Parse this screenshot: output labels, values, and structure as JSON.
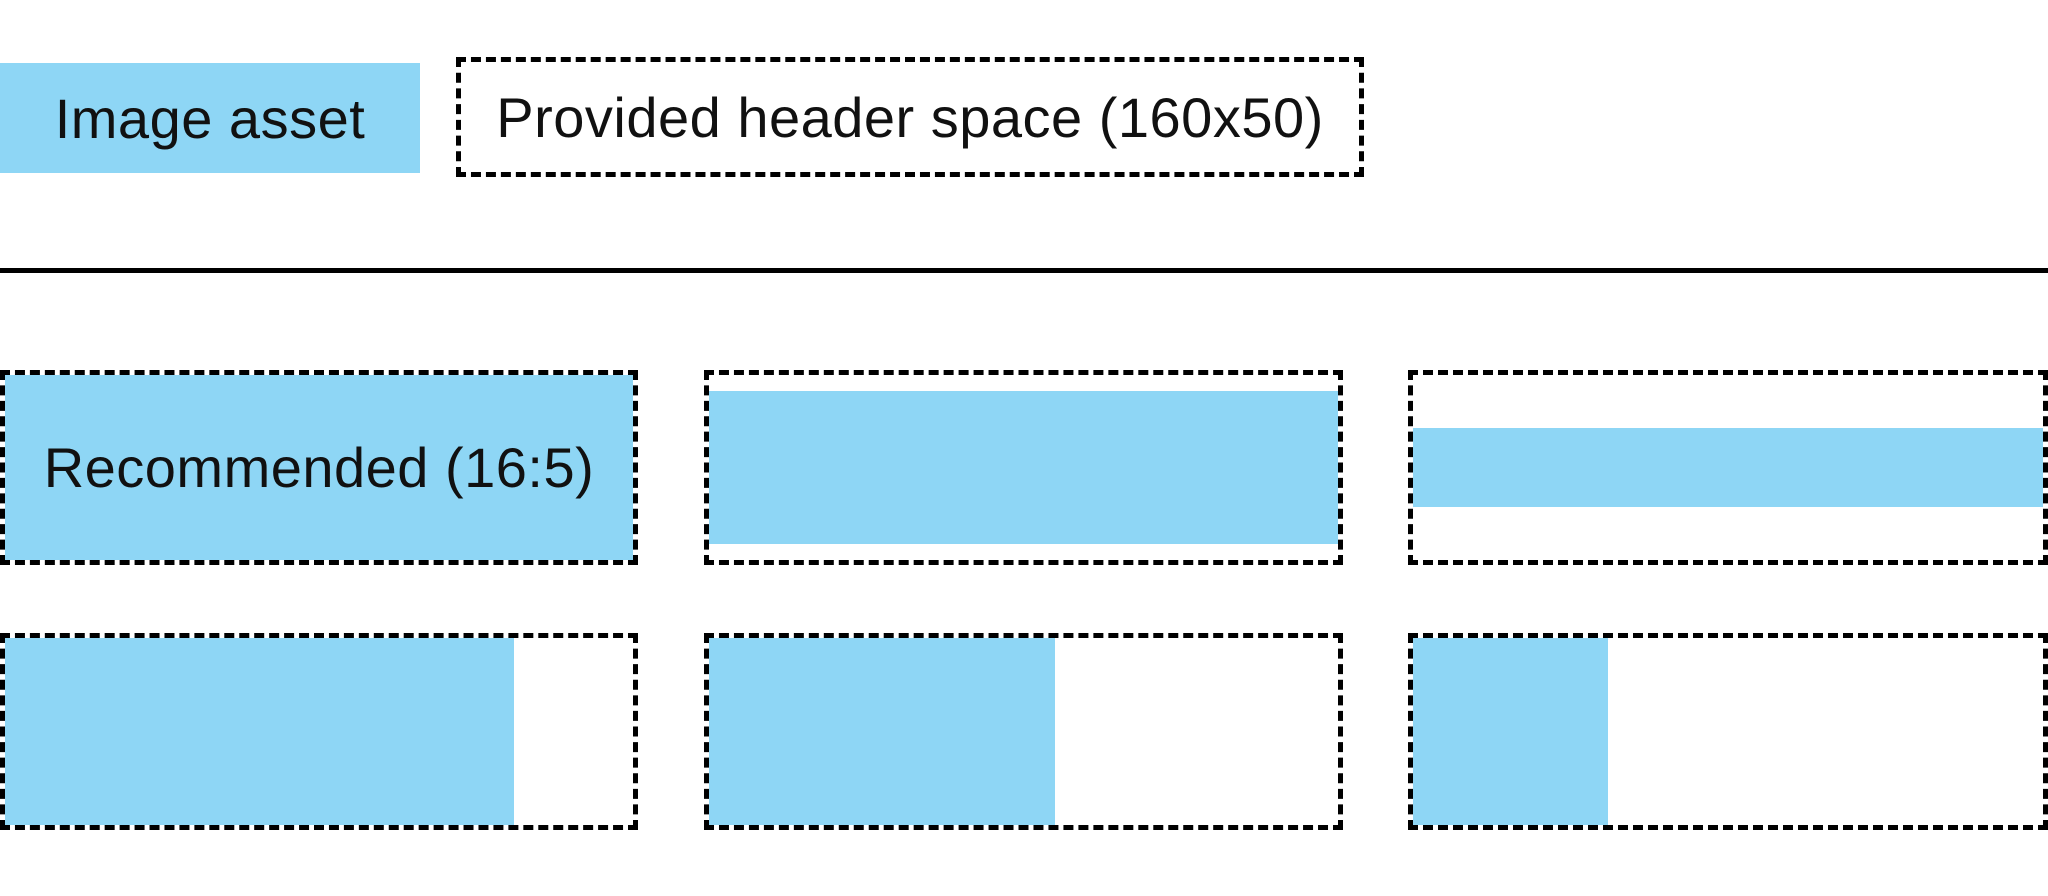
{
  "colors": {
    "asset_blue": "#8ed6f5",
    "outline": "#000000",
    "divider": "#000000",
    "text": "#111111",
    "background": "#ffffff"
  },
  "legend": {
    "image_asset_label": "Image asset",
    "header_space_label": "Provided header space (160x50)"
  },
  "examples": {
    "recommended_label": "Recommended (16:5)",
    "items": [
      {
        "name": "recommended-16-5",
        "label": "Recommended (16:5)",
        "fill": {
          "width_pct": 100,
          "height_pct": 100,
          "h_align": "left",
          "v_align": "center"
        }
      },
      {
        "name": "full-width-83pct-height",
        "label": "",
        "fill": {
          "width_pct": 100,
          "height_pct": 83,
          "h_align": "left",
          "v_align": "center"
        }
      },
      {
        "name": "full-width-43pct-height",
        "label": "",
        "fill": {
          "width_pct": 100,
          "height_pct": 43,
          "h_align": "left",
          "v_align": "center"
        }
      },
      {
        "name": "full-height-81pct-width",
        "label": "",
        "fill": {
          "width_pct": 81,
          "height_pct": 100,
          "h_align": "left",
          "v_align": "center"
        }
      },
      {
        "name": "full-height-55pct-width",
        "label": "",
        "fill": {
          "width_pct": 55,
          "height_pct": 100,
          "h_align": "left",
          "v_align": "center"
        }
      },
      {
        "name": "full-height-31pct-width",
        "label": "",
        "fill": {
          "width_pct": 31,
          "height_pct": 100,
          "h_align": "left",
          "v_align": "center"
        }
      }
    ]
  }
}
